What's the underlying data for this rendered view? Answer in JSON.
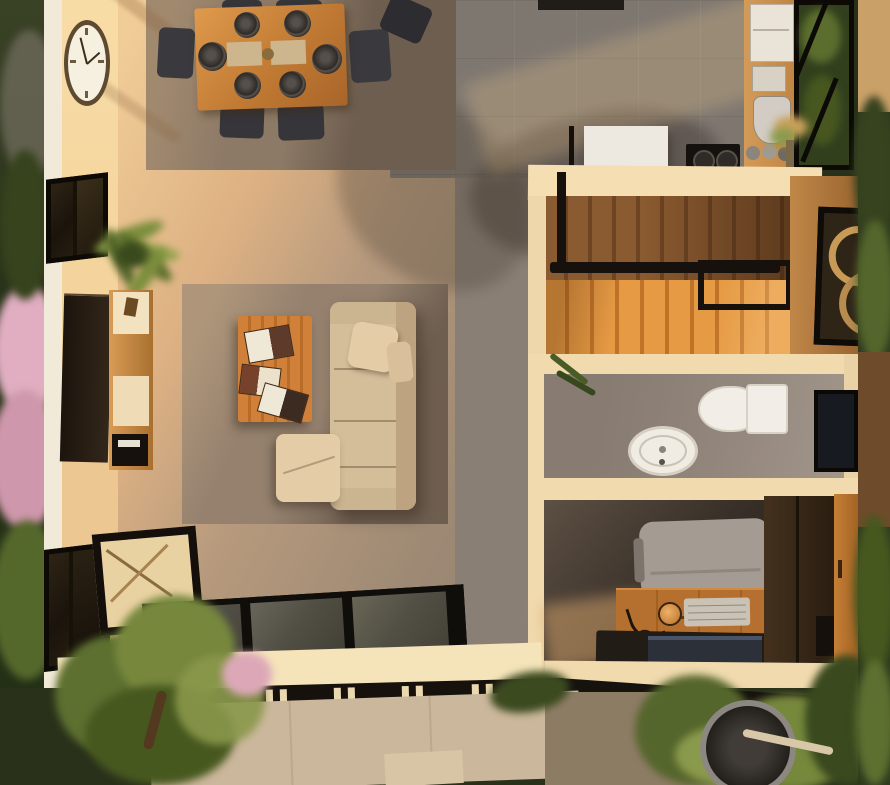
{
  "scene": {
    "kind": "3d-floorplan-top-down-render",
    "description": "Photorealistic top-down render of a one-storey home at sunset: dining area with set table, living room with sofa and coffee table, kitchen, wooden staircase, bathroom, home office, glass floor panels, entry gate and gardens.",
    "visible_text": "none"
  },
  "labels": {
    "scene": "3D floor plan render",
    "garden_left": "Left garden with pink blossoms",
    "garden_right": "Right garden strip",
    "garden_bottom": "Front garden",
    "walkway": "Concrete walkway",
    "gravel": "Gravel bed",
    "planter": "Round planter",
    "gate": "Entry gate with slats",
    "beam": "Black pergola beam",
    "dining_area": "Dining area",
    "dining_rug": "Dining rug",
    "dining_table": "Dining table",
    "dining_chair": "Dining chair",
    "plate": "Place setting",
    "placemat": "Placemat",
    "wall_clock": "Wall clock",
    "window": "Window",
    "palm_plant": "Potted palm plant",
    "tv": "Wall-mounted TV",
    "tv_console": "TV console",
    "speaker": "Speaker",
    "floor_lamp": "Floor lamp",
    "living_room": "Living room",
    "living_rug": "Living room rug",
    "coffee_table": "Coffee table",
    "books": "Open books",
    "sofa": "Sofa",
    "cushion": "Throw cushion",
    "ottoman": "Ottoman chaise",
    "accent_chair": "Accent chair",
    "glass_floor": "Glass floor panels",
    "kitchen": "Kitchen",
    "range_hood": "Range hood",
    "island": "Kitchen island",
    "cooktop": "Cooktop",
    "counter": "Kitchen counter",
    "fridge": "Refrigerator",
    "kettle": "Kettle",
    "jars": "Jars",
    "vase": "Flower vase",
    "stairs": "Wooden staircase",
    "railing": "Stair railing",
    "decor_panel": "Decorative wall panel",
    "bathroom": "Bathroom",
    "toilet": "Toilet",
    "sink": "Sink basin",
    "mirror": "Mirror",
    "bath_plant": "Bathroom plant",
    "office": "Home office",
    "office_chair": "Office chair",
    "desk": "Wooden desk",
    "keyboard": "Keyboard",
    "desk_lamp": "Desk lamp",
    "laptop": "Laptop",
    "wardrobe": "Wardrobe",
    "door": "Wooden door",
    "wall": "Wall",
    "shadow": "Cast shadow"
  },
  "palette": {
    "exterior_green": "#2a331a",
    "green_mid": "#5d7030",
    "green_light": "#8a984b",
    "pink_bloom": "#dfaebc",
    "outer_wall": "#f2ead8",
    "wall_lit": "#f6d9a3",
    "wall_cream": "#f0daae",
    "floor_warm": "#c9a87c",
    "floor_gray": "#7e7770",
    "corridor_gray": "#8a7f75",
    "dining_rug": "#8c7966",
    "living_rug": "#95816e",
    "wood": "#c8863f",
    "wood_bright": "#e69a44",
    "wood_dark": "#8a5a30",
    "desk_wood": "#b5702f",
    "metal_black": "#16110d",
    "sofa_beige": "#d4bd99",
    "cushion_beige": "#e4cda6",
    "white_fixture": "#f2eee7",
    "chair_gray": "#a49b93",
    "glass": "#5a574b",
    "walkway": "#cbb79b",
    "gravel": "#8d7c64",
    "office_dark": "#2b241e"
  }
}
